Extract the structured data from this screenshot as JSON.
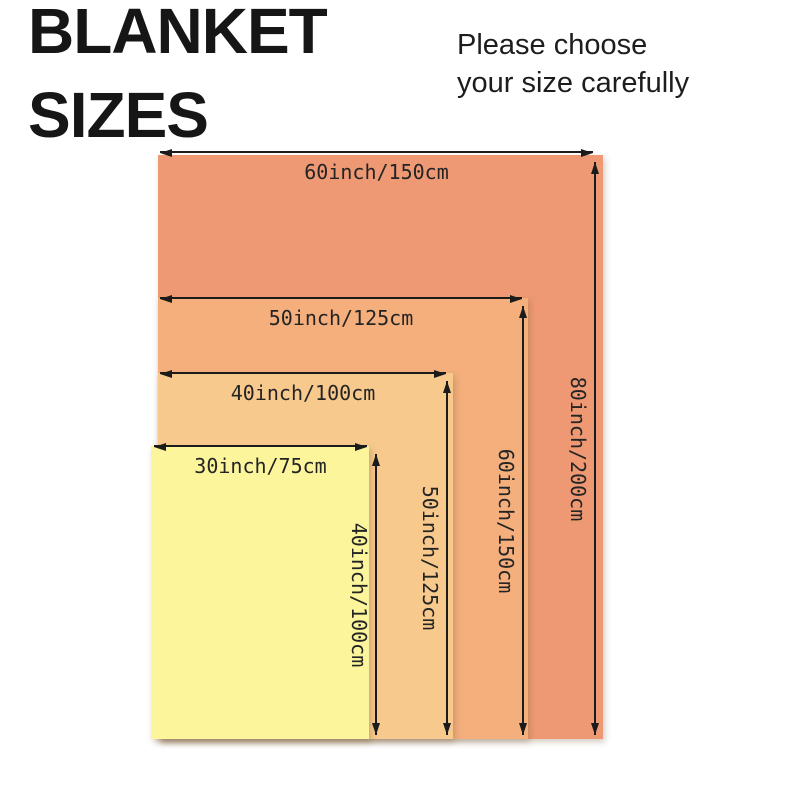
{
  "title": {
    "line1": "BLANKET",
    "line2": "SIZES"
  },
  "subtitle": {
    "line1": "Please choose",
    "line2": "your size carefully"
  },
  "blankets": [
    {
      "id": "60x80",
      "width_label": "60inch/150cm",
      "height_label": "80inch/200cm",
      "width_in": 60,
      "width_cm": 150,
      "height_in": 80,
      "height_cm": 200,
      "color": "#EE9973"
    },
    {
      "id": "50x60",
      "width_label": "50inch/125cm",
      "height_label": "60inch/150cm",
      "width_in": 50,
      "width_cm": 125,
      "height_in": 60,
      "height_cm": 150,
      "color": "#F4AF7D"
    },
    {
      "id": "40x50",
      "width_label": "40inch/100cm",
      "height_label": "50inch/125cm",
      "width_in": 40,
      "width_cm": 100,
      "height_in": 50,
      "height_cm": 125,
      "color": "#F7C98C"
    },
    {
      "id": "30x40",
      "width_label": "30inch/75cm",
      "height_label": "40inch/100cm",
      "width_in": 30,
      "width_cm": 75,
      "height_in": 40,
      "height_cm": 100,
      "color": "#FCF59C"
    }
  ],
  "colors": {
    "line": "#1b1b1b",
    "text": "#242424",
    "background": "#ffffff"
  }
}
